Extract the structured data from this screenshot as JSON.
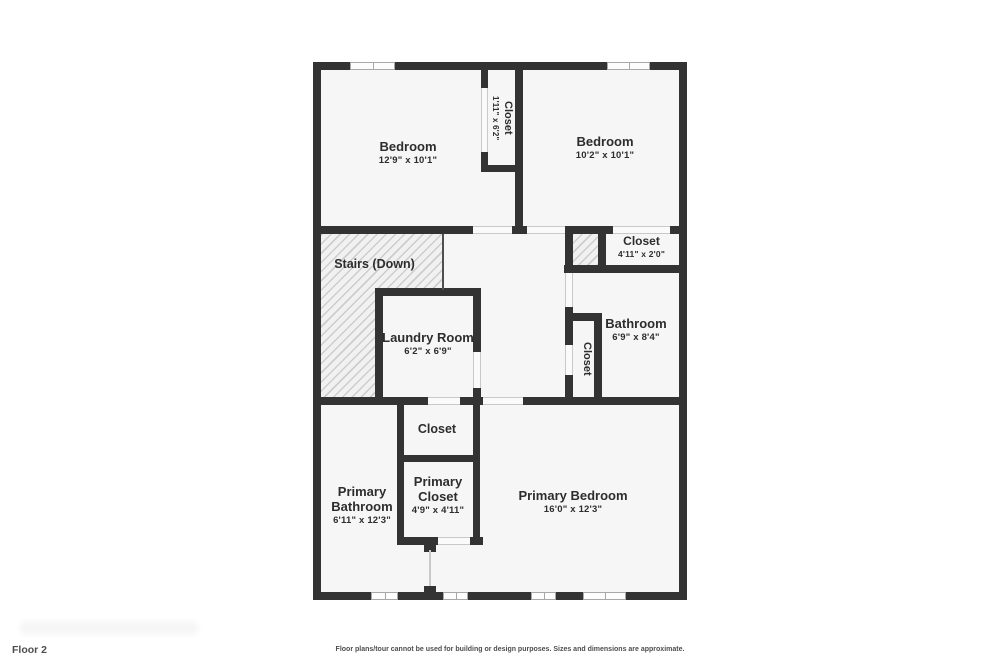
{
  "floor_plan": {
    "rooms": {
      "bedroom_1": {
        "name": "Bedroom",
        "dims": "12'9\" x 10'1\""
      },
      "bedroom_1_closet": {
        "name": "Closet",
        "dims": "1'11\" x 6'2\""
      },
      "bedroom_2": {
        "name": "Bedroom",
        "dims": "10'2\" x 10'1\""
      },
      "bedroom_2_closet": {
        "name": "Closet",
        "dims": "4'11\" x 2'0\""
      },
      "stairs": {
        "name": "Stairs (Down)"
      },
      "laundry_room": {
        "name": "Laundry Room",
        "dims": "6'2\" x 6'9\""
      },
      "bathroom": {
        "name": "Bathroom",
        "dims": "6'9\" x 8'4\""
      },
      "linen_closet": {
        "name": "Closet"
      },
      "hallway_closet": {
        "name": "Closet"
      },
      "primary_bathroom": {
        "name": "Primary Bathroom",
        "dims": "6'11\" x 12'3\""
      },
      "primary_closet": {
        "name": "Primary Closet",
        "dims": "4'9\" x 4'11\""
      },
      "primary_bedroom": {
        "name": "Primary Bedroom",
        "dims": "16'0\" x 12'3\""
      }
    },
    "footer": {
      "floor_label": "Floor 2",
      "disclaimer": "Floor plans/tour cannot be used for building or design purposes. Sizes and dimensions are approximate."
    },
    "colors": {
      "wall": "#333333",
      "floor": "#f6f6f6",
      "hatch_line": "#cdcdcd",
      "text": "#2d2d2d"
    }
  }
}
